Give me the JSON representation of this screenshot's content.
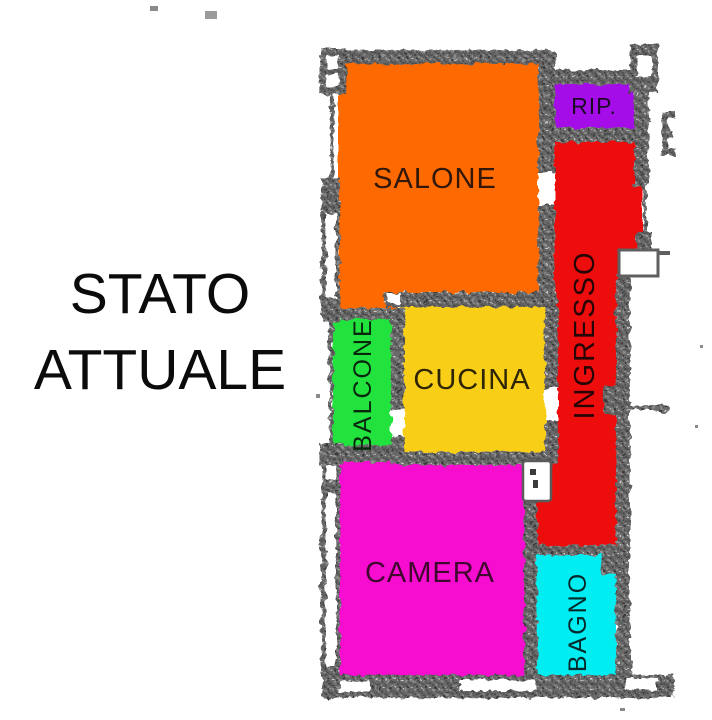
{
  "title": {
    "line1": "STATO",
    "line2": "ATTUALE",
    "color": "#0b0b0b"
  },
  "floorplan": {
    "background": "#ffffff",
    "wall_color": "#6b6b6b",
    "rooms": {
      "salone": {
        "label": "SALONE",
        "color": "#ff6a00",
        "label_color": "#33180a",
        "orientation": "horizontal"
      },
      "rip": {
        "label": "RIP.",
        "color": "#a50ae8",
        "label_color": "#1d0b26",
        "orientation": "horizontal"
      },
      "ingresso": {
        "label": "INGRESSO",
        "color": "#ee0808",
        "label_color": "#260505",
        "orientation": "vertical"
      },
      "balcone": {
        "label": "BALCONE",
        "color": "#20e23c",
        "label_color": "#08270d",
        "orientation": "vertical"
      },
      "cucina": {
        "label": "CUCINA",
        "color": "#f8ce14",
        "label_color": "#2e2506",
        "orientation": "horizontal"
      },
      "camera": {
        "label": "CAMERA",
        "color": "#f70cd0",
        "label_color": "#40082f",
        "orientation": "horizontal"
      },
      "bagno": {
        "label": "BAGNO",
        "color": "#04eef2",
        "label_color": "#05292b",
        "orientation": "vertical"
      }
    }
  }
}
